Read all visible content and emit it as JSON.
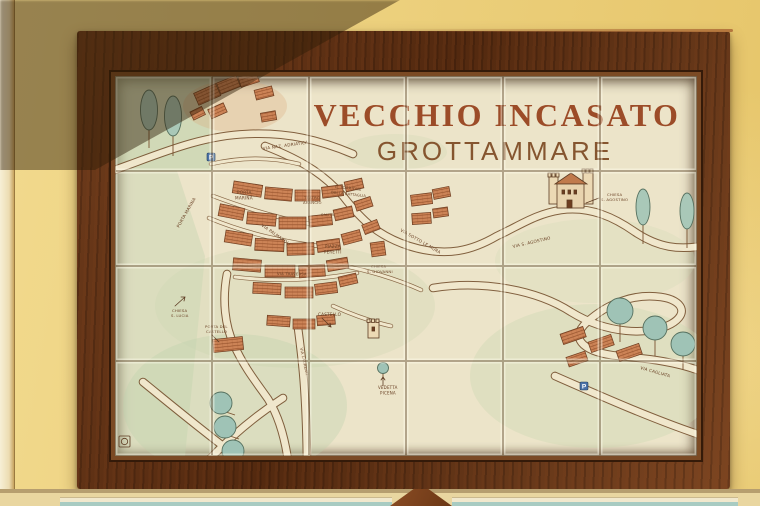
{
  "artwork": {
    "title": "VECCHIO INCASATO",
    "subtitle": "GROTTAMMARE"
  },
  "map": {
    "labels": [
      {
        "t": "VIA NAZ. ADRIATICA",
        "x": 148,
        "y": 74,
        "r": -8,
        "s": 4.2
      },
      {
        "t": "PORTA",
        "x": 122,
        "y": 118,
        "s": 4.2
      },
      {
        "t": "MARINA",
        "x": 120,
        "y": 123.5,
        "s": 4.2
      },
      {
        "t": "PORTA MARINA",
        "x": 64,
        "y": 152,
        "r": -60,
        "s": 4.2
      },
      {
        "t": "TEATRO",
        "x": 189,
        "y": 123,
        "s": 3.8
      },
      {
        "t": "ARANCIO",
        "x": 188,
        "y": 128,
        "s": 3.8
      },
      {
        "t": "IL TORRIONE",
        "x": 220,
        "y": 112,
        "r": 6,
        "s": 3.8
      },
      {
        "t": "DELLA BATTAGLIA",
        "x": 216,
        "y": 117.5,
        "r": 6,
        "s": 3.6
      },
      {
        "t": "SALITA",
        "x": 206,
        "y": 140,
        "s": 3.5
      },
      {
        "t": "VIA PALMAROLI",
        "x": 146,
        "y": 150,
        "r": 35,
        "s": 4.2
      },
      {
        "t": "PIAZZA",
        "x": 210,
        "y": 172,
        "s": 4
      },
      {
        "t": "PERETTI",
        "x": 209,
        "y": 177.5,
        "s": 4
      },
      {
        "t": "CHIESA",
        "x": 256,
        "y": 192,
        "s": 3.8
      },
      {
        "t": "S. GIOVANNI",
        "x": 252,
        "y": 197,
        "s": 3.8
      },
      {
        "t": "VIA SOTTO LE MURA",
        "x": 285,
        "y": 155,
        "r": 30,
        "s": 4.2
      },
      {
        "t": "VIA S. AGOSTINO",
        "x": 398,
        "y": 172,
        "r": -13,
        "s": 4.2
      },
      {
        "t": "CHIESA",
        "x": 492,
        "y": 120,
        "s": 3.8
      },
      {
        "t": "S. AGOSTINO",
        "x": 486,
        "y": 125,
        "s": 3.8
      },
      {
        "t": "VIA TRAVERSA",
        "x": 162,
        "y": 199,
        "r": 1,
        "s": 3.8
      },
      {
        "t": "CHIESA",
        "x": 57,
        "y": 236,
        "s": 3.8
      },
      {
        "t": "S. LUCIA",
        "x": 56,
        "y": 241,
        "s": 3.8
      },
      {
        "t": "CASTELLO",
        "x": 203,
        "y": 240,
        "s": 4.2
      },
      {
        "t": "PORTA DEL",
        "x": 90,
        "y": 252,
        "s": 3.8
      },
      {
        "t": "CASTELLO",
        "x": 91,
        "y": 257,
        "s": 3.8
      },
      {
        "t": "VIA LAUREATI",
        "x": 185,
        "y": 272,
        "r": 78,
        "s": 3.8
      },
      {
        "t": "VEDETTA",
        "x": 263,
        "y": 313,
        "s": 4
      },
      {
        "t": "PICENA",
        "x": 265,
        "y": 318.5,
        "s": 4
      },
      {
        "t": "VIA CAGLIATA",
        "x": 525,
        "y": 293,
        "r": 16,
        "s": 4.2
      }
    ],
    "parking_signs": [
      {
        "letter": "P",
        "x": 92,
        "y": 77
      },
      {
        "letter": "P",
        "x": 465,
        "y": 306
      }
    ]
  },
  "colors": {
    "wall_yellow": "#ecd07d",
    "frame_wood": "#5c3015",
    "tile_ivory": "#ece4c9",
    "title_rust": "#9c4c28",
    "map_ink": "#5d3b22",
    "building_terracotta": "#cd8457",
    "tree_green": "#a9c8b8",
    "wash_green": "#c2d2ae",
    "road_cream": "#f0e7cc",
    "parking_blue": "#4a72a8"
  }
}
